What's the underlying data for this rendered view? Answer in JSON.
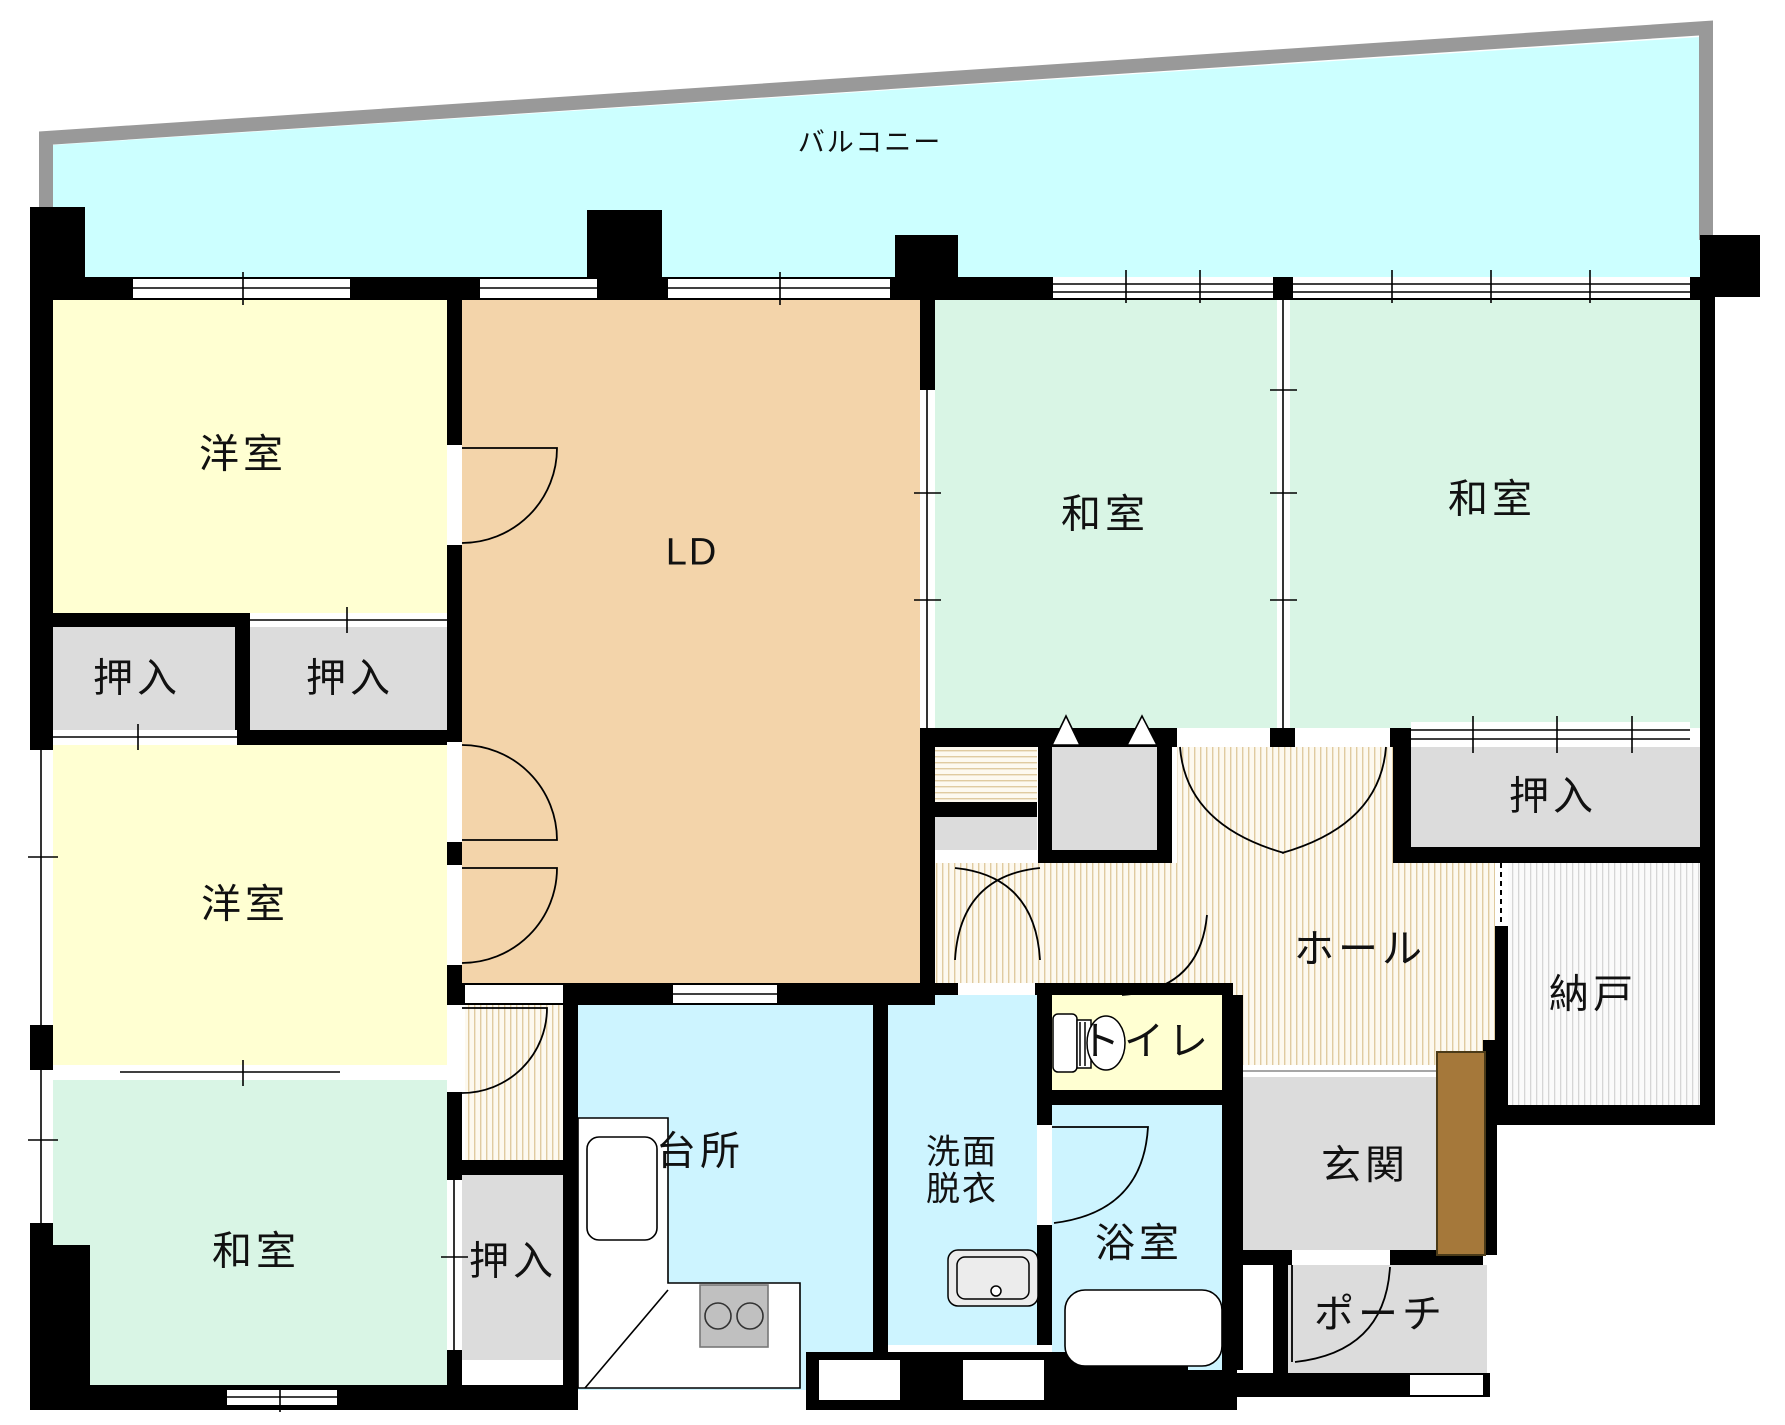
{
  "title": "マンション間取り図",
  "type": "floor-plan",
  "balcony": {
    "label": "バルコニー"
  },
  "rooms": {
    "yoshitsu1": {
      "label": "洋室"
    },
    "yoshitsu2": {
      "label": "洋室"
    },
    "washitsu1": {
      "label": "和室"
    },
    "washitsu2": {
      "label": "和室"
    },
    "washitsu3": {
      "label": "和室"
    },
    "ld": {
      "label": "LD"
    },
    "oshiire1": {
      "label": "押入"
    },
    "oshiire2": {
      "label": "押入"
    },
    "oshiire3": {
      "label": "押入"
    },
    "oshiire4": {
      "label": "押入"
    },
    "hall": {
      "label": "ホール"
    },
    "nando": {
      "label": "納戸"
    },
    "toilet": {
      "label": "トイレ"
    },
    "kitchen": {
      "label": "台所"
    },
    "senmen": {
      "line1": "洗面",
      "line2": "脱衣"
    },
    "bath": {
      "label": "浴室"
    },
    "genkan": {
      "label": "玄関"
    },
    "porch": {
      "label": "ポーチ"
    }
  },
  "colors": {
    "wall": "#000000",
    "balcony_fill": "#CCFFFF",
    "balcony_rail": "#999999",
    "western_room": "#FFFFD2",
    "japanese_room": "#D9F5E5",
    "living_dining": "#F3D4AA",
    "wet_area": "#CDF4FF",
    "toilet_room": "#FFFFD2",
    "closet": "#DCDCDC",
    "entry": "#DCDCDC",
    "hall_stripe": "#E0CBA0",
    "nando_stripe": "#D6D6D6",
    "front_door": "#A5783A"
  }
}
